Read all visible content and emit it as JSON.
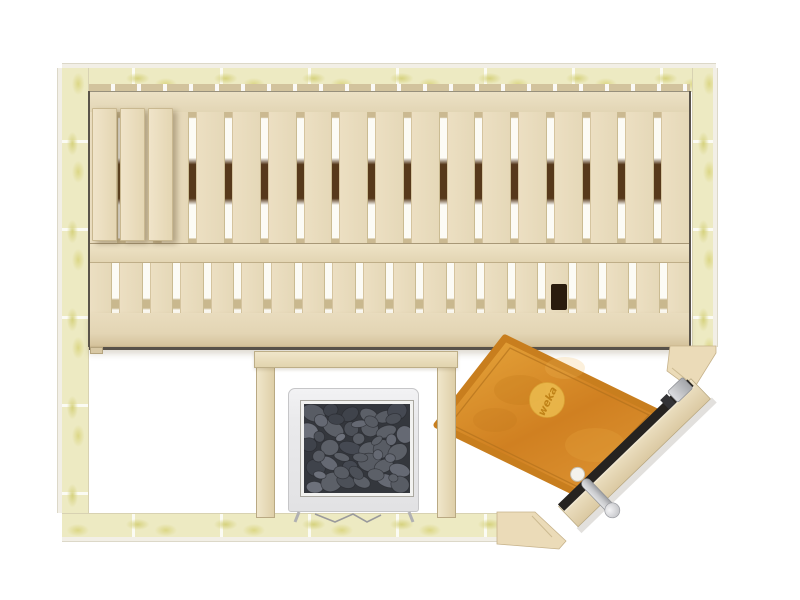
{
  "brand": {
    "logo_text": "weka"
  },
  "room": {
    "bench": {
      "upper_slat_count": 17,
      "lower_slat_count": 20,
      "headrest_plank_count": 3
    },
    "heater": {
      "stones": {
        "cols": 6,
        "rows": 5
      }
    }
  },
  "colors": {
    "floor": "#ffffff",
    "insulation": "#edeac2",
    "insulation_spots": "#dcd786",
    "wall_edge_wood": "#f2efe6",
    "wood_light": "#e9ddbf",
    "wood_band": "#e3d6b5",
    "wood_dark_edge": "#57514a",
    "slat_gap_shadow": "#57391b",
    "heater_body": "#e9e9eb",
    "heater_stones": "#4c5058",
    "mat_orange": "#d58927",
    "mat_logo_circle": "#eec052",
    "door_glass": "#262320",
    "metal_hardware": "#c6c7cb"
  }
}
